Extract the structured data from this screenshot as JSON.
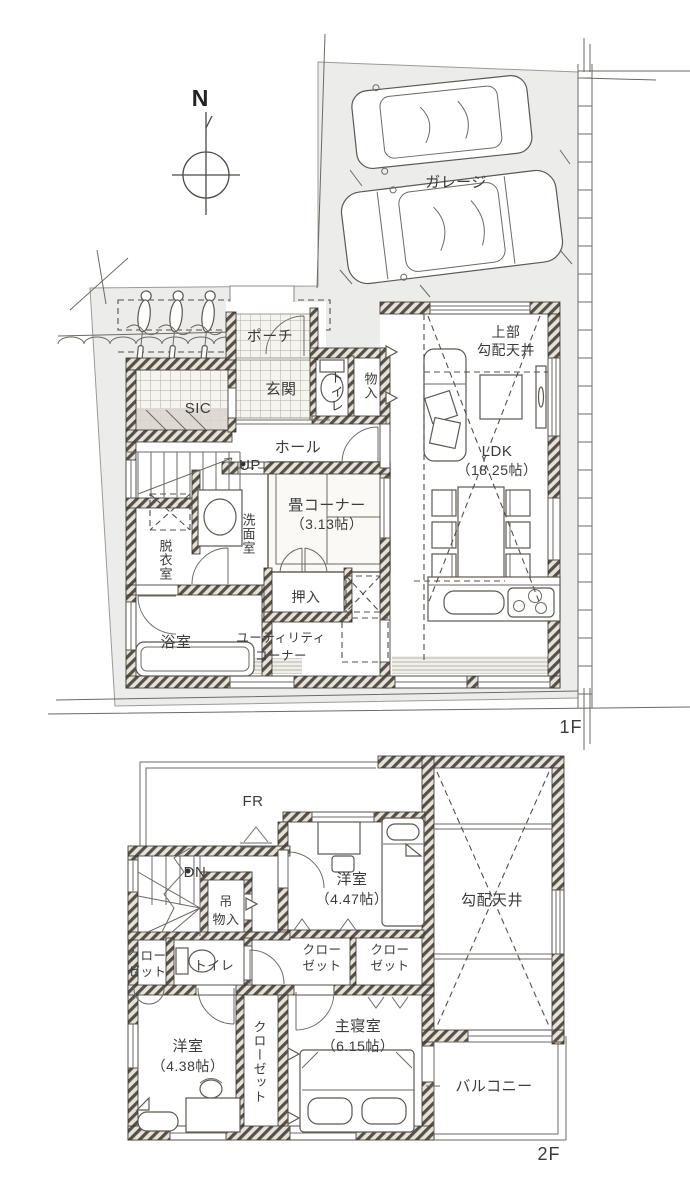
{
  "title": "戸建て間取り図（1F・2F）",
  "colors": {
    "site_fill": "#ececea",
    "wall_stripe": "#55504a",
    "wall_bg": "#e7e2d8",
    "line": "#4a4a46",
    "text": "#3b3b3b"
  },
  "compass": {
    "north": "N"
  },
  "site": {
    "garage": "ガレージ"
  },
  "floor1": {
    "label": "1F",
    "porch": "ポーチ",
    "entrance": "玄関",
    "toilet": "トイレ",
    "storage": "物入",
    "sic": "SIC",
    "hall": "ホール",
    "up": "UP",
    "tatami": {
      "name": "畳コーナー",
      "size": "（3.13帖）"
    },
    "washroom": "洗面室",
    "dressing": "脱衣室",
    "oshiire": "押入",
    "bath": "浴室",
    "utility": {
      "line1": "ユーティリティ",
      "line2": "コーナー"
    },
    "ldk": {
      "name": "LDK",
      "size": "（18.25帖）"
    },
    "upper_sloped": {
      "line1": "上部",
      "line2": "勾配天井"
    }
  },
  "floor2": {
    "label": "2F",
    "fr": "FR",
    "dn": "DN",
    "hanging": {
      "line1": "吊",
      "line2": "物入"
    },
    "closet": {
      "line1": "クロー",
      "line2": "ゼット",
      "vertical": "クローゼット"
    },
    "toilet": "トイレ",
    "bedroom1": {
      "name": "洋室",
      "size": "（4.47帖）"
    },
    "bedroom2": {
      "name": "洋室",
      "size": "（4.38帖）"
    },
    "master": {
      "name": "主寝室",
      "size": "（6.15帖）"
    },
    "sloped_ceiling": "勾配天井",
    "balcony": "バルコニー"
  }
}
